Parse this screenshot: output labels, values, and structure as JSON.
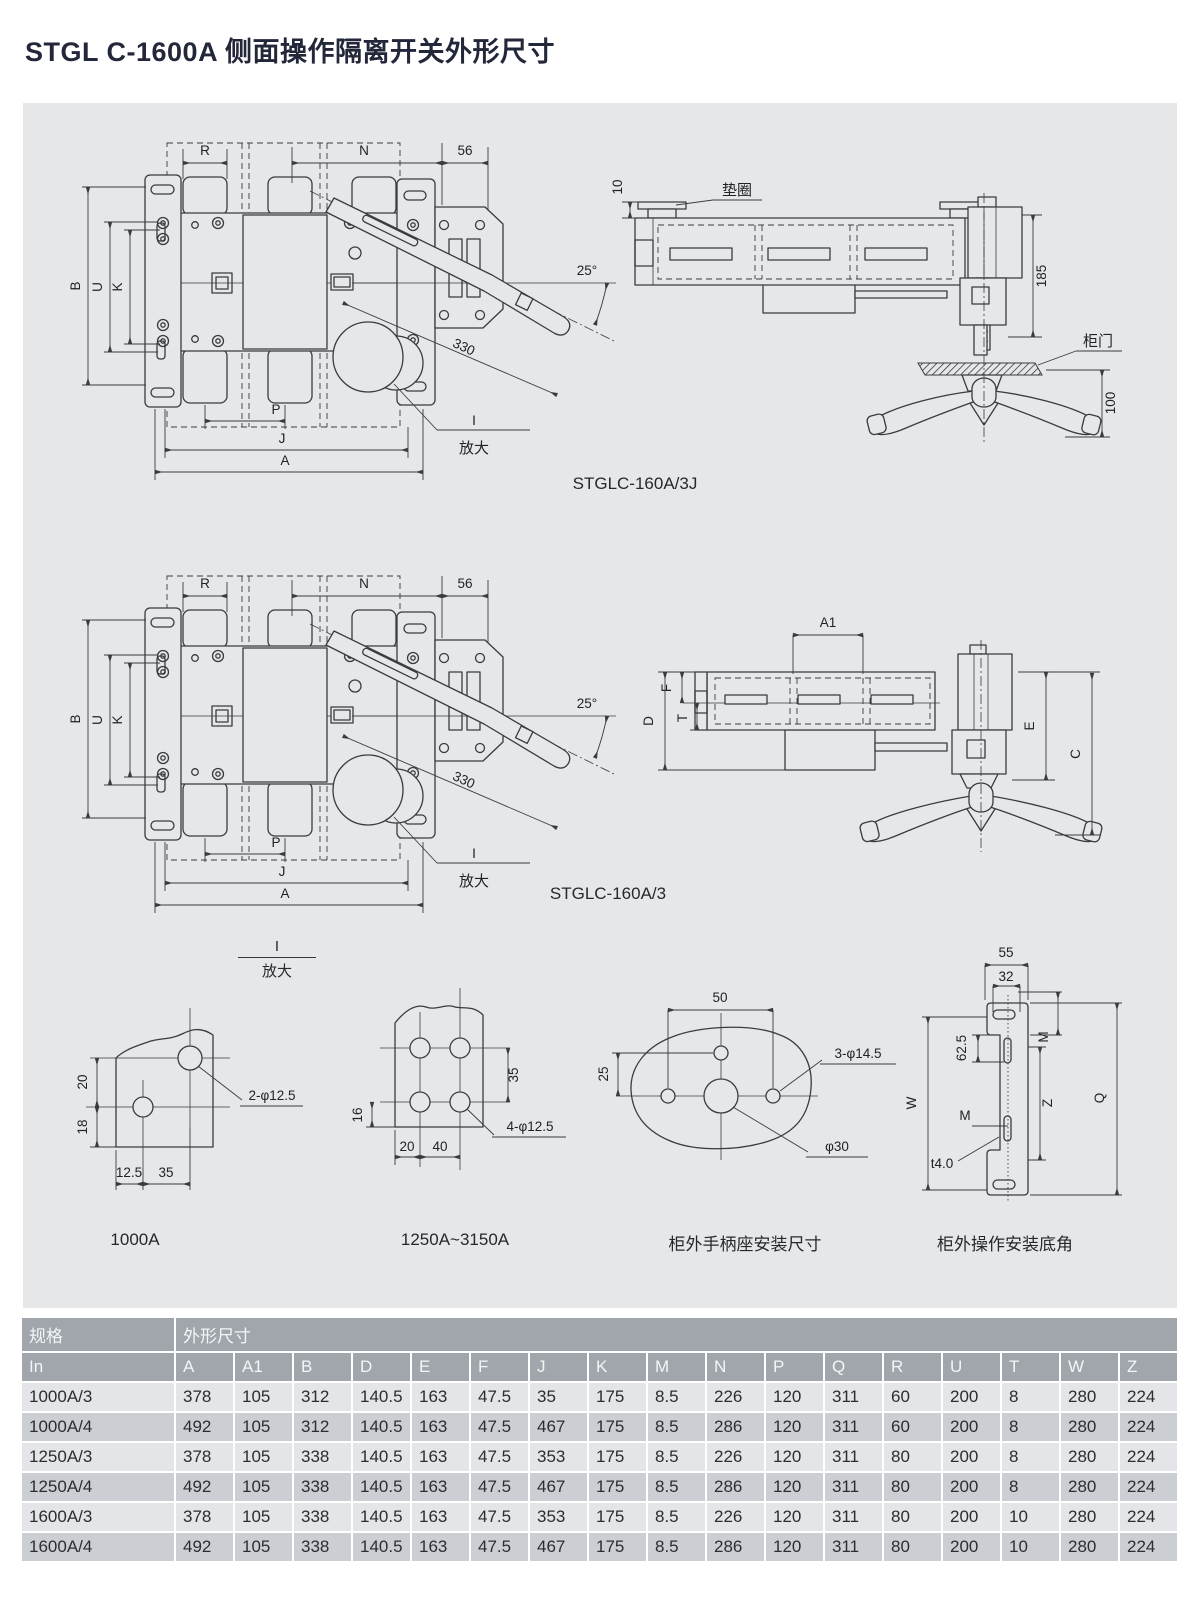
{
  "page": {
    "title": "STGL C-1600A 侧面操作隔离开关外形尺寸"
  },
  "front_view": {
    "dims": {
      "r": "R",
      "n": "N",
      "n56": "56",
      "b": "B",
      "u": "U",
      "k": "K",
      "p": "P",
      "j": "J",
      "a": "A",
      "angle": "25°",
      "len": "330",
      "detail_ref": "I",
      "detail_zoom": "放大"
    }
  },
  "side_view_j": {
    "dims": {
      "d10": "10",
      "washer": "垫圈",
      "d185": "185",
      "door": "柜门",
      "d100": "100"
    },
    "caption": "STGLC-160A/3J"
  },
  "side_view": {
    "dims": {
      "a1": "A1",
      "f": "F",
      "t": "T",
      "d": "D",
      "e": "E",
      "c": "C"
    },
    "caption": "STGLC-160A/3"
  },
  "detail_marker": {
    "ref": "I",
    "zoom": "放大"
  },
  "detail_1000a": {
    "dims": {
      "d20": "20",
      "d18": "18",
      "d12_5": "12.5",
      "d35": "35",
      "holes": "2-φ12.5"
    },
    "caption": "1000A"
  },
  "detail_1250a": {
    "dims": {
      "d35": "35",
      "d16": "16",
      "d20": "20",
      "d40": "40",
      "holes": "4-φ12.5"
    },
    "caption": "1250A~3150A"
  },
  "handle_seat": {
    "dims": {
      "d50": "50",
      "d25": "25",
      "holes": "3-φ14.5",
      "center": "φ30"
    },
    "caption": "柜外手柄座安装尺寸"
  },
  "mount_bracket": {
    "dims": {
      "d55": "55",
      "d32": "32",
      "m_top": "M",
      "d62_5": "62.5",
      "w": "W",
      "z": "Z",
      "m_mid": "M",
      "t40": "t4.0",
      "q": "Q"
    },
    "caption": "柜外操作安装底角"
  },
  "table": {
    "header_spec": "规格",
    "header_dims": "外形尺寸",
    "columns": [
      "In",
      "A",
      "A1",
      "B",
      "D",
      "E",
      "F",
      "J",
      "K",
      "M",
      "N",
      "P",
      "Q",
      "R",
      "U",
      "T",
      "W",
      "Z"
    ],
    "rows": [
      [
        "1000A/3",
        "378",
        "105",
        "312",
        "140.5",
        "163",
        "47.5",
        "35",
        "175",
        "8.5",
        "226",
        "120",
        "311",
        "60",
        "200",
        "8",
        "280",
        "224"
      ],
      [
        "1000A/4",
        "492",
        "105",
        "312",
        "140.5",
        "163",
        "47.5",
        "467",
        "175",
        "8.5",
        "286",
        "120",
        "311",
        "60",
        "200",
        "8",
        "280",
        "224"
      ],
      [
        "1250A/3",
        "378",
        "105",
        "338",
        "140.5",
        "163",
        "47.5",
        "353",
        "175",
        "8.5",
        "226",
        "120",
        "311",
        "80",
        "200",
        "8",
        "280",
        "224"
      ],
      [
        "1250A/4",
        "492",
        "105",
        "338",
        "140.5",
        "163",
        "47.5",
        "467",
        "175",
        "8.5",
        "286",
        "120",
        "311",
        "80",
        "200",
        "8",
        "280",
        "224"
      ],
      [
        "1600A/3",
        "378",
        "105",
        "338",
        "140.5",
        "163",
        "47.5",
        "353",
        "175",
        "8.5",
        "226",
        "120",
        "311",
        "80",
        "200",
        "10",
        "280",
        "224"
      ],
      [
        "1600A/4",
        "492",
        "105",
        "338",
        "140.5",
        "163",
        "47.5",
        "467",
        "175",
        "8.5",
        "286",
        "120",
        "311",
        "80",
        "200",
        "10",
        "280",
        "224"
      ]
    ]
  }
}
